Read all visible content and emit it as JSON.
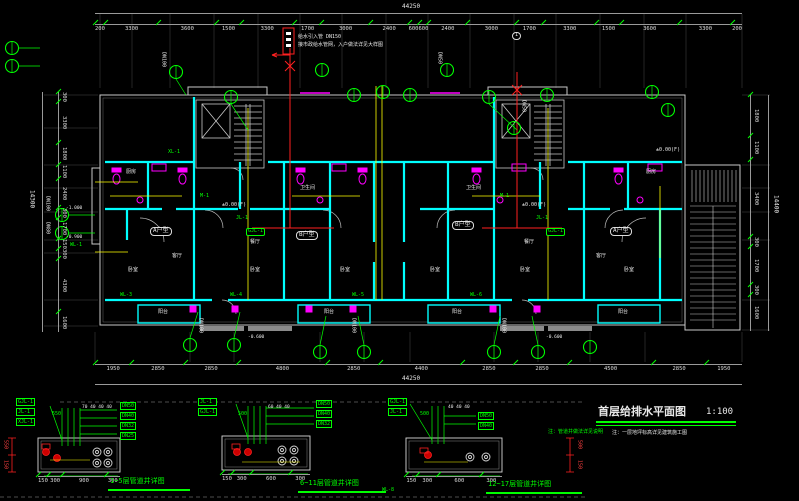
{
  "title_block": {
    "title": "首层给排水平面图",
    "scale": "1:100",
    "note": "注：一层地坪标高详见建筑施工图"
  },
  "supply_note": {
    "line1": "给水引入管 DN150",
    "line2": "接市政给水管网，入户做法详见大样图"
  },
  "markers": {
    "section": "1"
  },
  "dims": {
    "top_overall": "44250",
    "top": [
      "200",
      "3300",
      "3600",
      "1500",
      "3300",
      "1700",
      "3000",
      "2400",
      "600",
      "600",
      "2400",
      "3000",
      "1700",
      "3300",
      "1500",
      "3600",
      "3300",
      "200"
    ],
    "bottom_overall": "44250",
    "bottom": [
      "1950",
      "2850",
      "2850",
      "4800",
      "2850",
      "4400",
      "2850",
      "2850",
      "4500",
      "2850",
      "1950"
    ],
    "left_overall": "14300",
    "left": [
      "300",
      "3300",
      "1800",
      "1100",
      "2400",
      "300",
      "1700",
      "150",
      "300",
      "4300",
      "1600"
    ],
    "right_overall": "14400",
    "right": [
      "1800",
      "1100",
      "3400",
      "300",
      "1700",
      "300",
      "1600"
    ]
  },
  "plan": {
    "units": [
      "A户型",
      "B户型",
      "B户型",
      "A户型"
    ],
    "rooms": {
      "kitchen": "厨房",
      "living": "客厅",
      "bedroom": "卧室",
      "bath": "卫生间",
      "balcony": "阳台",
      "dining": "餐厅"
    },
    "risers": {
      "m1": "M-1",
      "jl1": "JL-1",
      "gjl1": "GJL-1",
      "xl1": "XL-1",
      "wl1": "WL-1",
      "wl3": "WL-3",
      "wl4": "WL-4",
      "wl5": "WL-5",
      "wl6": "WL-6"
    },
    "pipes": {
      "dn100": "DN100",
      "dn80": "DN80",
      "dn50": "DN50"
    },
    "elevations": {
      "zero": "±0.00(F)",
      "minus06": "-0.600",
      "minus09": "-0.900",
      "minus10": "-1.000"
    }
  },
  "details": [
    {
      "title": "1~5层管道井详图",
      "left_labels": [
        "GJL-1",
        "JL-1",
        "XJL-1"
      ],
      "right_labels": [
        "DN50",
        "DN40",
        "DN32",
        "DN25"
      ],
      "top_dim": "550",
      "top_spacing": "70 40 40 40",
      "bottom_dims": [
        "150",
        "300",
        "900",
        "300"
      ],
      "side_dims": [
        "550",
        "150"
      ]
    },
    {
      "title": "6~11层管道井详图",
      "left_labels": [
        "JL-1",
        "GJL-1"
      ],
      "right_labels": [
        "DN50",
        "DN40",
        "DN32"
      ],
      "top_dim": "500",
      "top_spacing": "60 40 40",
      "bottom_dims": [
        "150",
        "300",
        "600",
        "300"
      ],
      "side_dims": [
        "500",
        "150"
      ]
    },
    {
      "title": "12~17层管道井详图",
      "left_labels": [
        "GJL-1",
        "JL-1"
      ],
      "right_labels": [
        "DN50",
        "DN40"
      ],
      "top_dim": "500",
      "top_spacing": "40 40 40",
      "bottom_dims": [
        "150",
        "300",
        "600",
        "300"
      ],
      "side_dims": [
        "500",
        "150"
      ],
      "corner_label": "WL-8",
      "note": "注：管道井做法详见说明"
    }
  ],
  "colors": {
    "background": "#000000",
    "wall": "#00ffff",
    "fixture": "#ff00ff",
    "annotation": "#00ff00",
    "supply": "#ff0000",
    "pipe": "#ffff00",
    "line": "#c8c8c8"
  }
}
